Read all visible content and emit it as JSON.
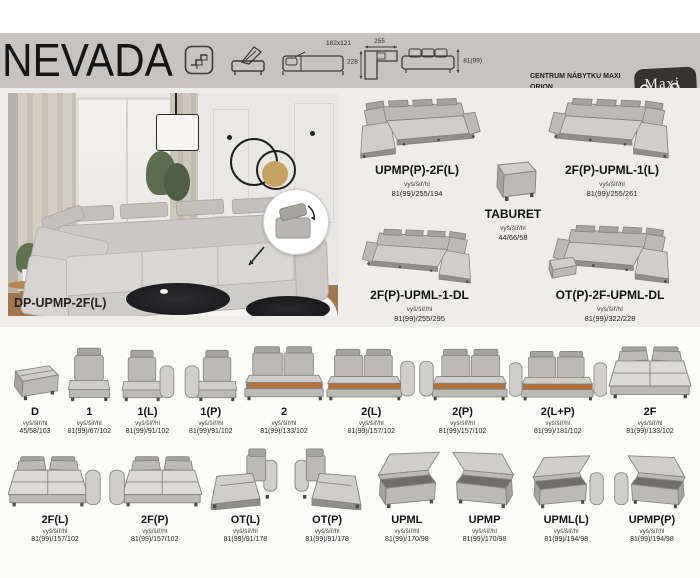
{
  "header": {
    "title": "NEVADA",
    "sleep_size": "182x121",
    "corner_width": "255",
    "corner_depth": "228",
    "height_dim": "81(99)",
    "contact": {
      "company": "CENTRUM NÁBYTKU MAXI ORION",
      "address": "Tovární 38, Olomouc",
      "call_label": "Zavolejte:",
      "phone": "775 559 401",
      "write_label": "Nebo pište na:",
      "email": "info@maxiorion.cz"
    },
    "logo": {
      "top": "Maxi",
      "bottom": "ORION"
    }
  },
  "showcase": {
    "photo_label": "DP-UPMP-2F(L)",
    "dims_label": "vyš/šíř/hl",
    "configs": [
      {
        "name": "UPMP(P)-2F(L)",
        "dims": "81(99)/255/194",
        "shape": "corner-left"
      },
      {
        "name": "2F(P)-UPML-1(L)",
        "dims": "81(99)/255/261",
        "shape": "corner-right"
      },
      {
        "name": "TABURET",
        "dims": "44/66/58",
        "shape": "taburet"
      },
      {
        "name": "2F(P)-UPML-1-DL",
        "dims": "81(99)/255/295",
        "shape": "corner-right-long"
      },
      {
        "name": "OT(P)-2F-UPML-DL",
        "dims": "81(99)/322/228",
        "shape": "corner-u"
      }
    ]
  },
  "modules": {
    "dims_label": "vyš/šíř/hl",
    "row1": [
      {
        "name": "D",
        "dims": "45/58/103",
        "shape": "pouf"
      },
      {
        "name": "1",
        "dims": "81(99)/67/102",
        "shape": "seat"
      },
      {
        "name": "1(L)",
        "dims": "81(99)/91/102",
        "shape": "seat-arm-right"
      },
      {
        "name": "1(P)",
        "dims": "81(99)/91/102",
        "shape": "seat-arm-left"
      },
      {
        "name": "2",
        "dims": "81(99)/133/102",
        "shape": "two-open"
      },
      {
        "name": "2(L)",
        "dims": "81(99)/157/102",
        "shape": "two-open-arm-right"
      },
      {
        "name": "2(P)",
        "dims": "81(99)/157/102",
        "shape": "two-open-arm-left"
      },
      {
        "name": "2(L+P)",
        "dims": "81(99)/181/102",
        "shape": "two-open-arm-both"
      },
      {
        "name": "2F",
        "dims": "81(99)/133/102",
        "shape": "flat"
      }
    ],
    "row2": [
      {
        "name": "2F(L)",
        "dims": "81(99)/157/102",
        "shape": "flat-arm-right"
      },
      {
        "name": "2F(P)",
        "dims": "81(99)/157/102",
        "shape": "flat-arm-left"
      },
      {
        "name": "OT(L)",
        "dims": "81(99)/91/178",
        "shape": "chaise-left"
      },
      {
        "name": "OT(P)",
        "dims": "81(99)/91/178",
        "shape": "chaise-right"
      },
      {
        "name": "UPML",
        "dims": "81(99)/170/98",
        "shape": "storage-left"
      },
      {
        "name": "UPMP",
        "dims": "81(99)/170/98",
        "shape": "storage-right"
      },
      {
        "name": "UPML(L)",
        "dims": "81(99)/194/98",
        "shape": "storage-arm-left"
      },
      {
        "name": "UPMP(P)",
        "dims": "81(99)/194/98",
        "shape": "storage-arm-right"
      }
    ]
  }
}
